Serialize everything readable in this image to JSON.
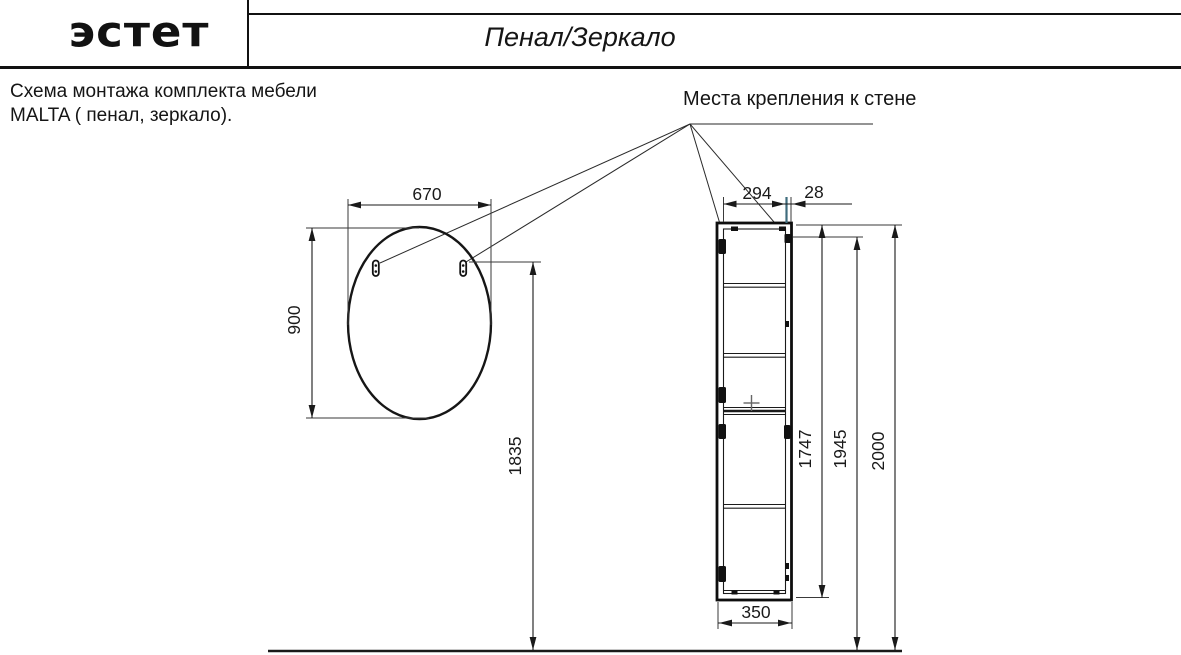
{
  "header": {
    "brand": "эстет",
    "title": "Пенал/Зеркало"
  },
  "intro": {
    "line1": "Схема монтажа комплекта мебели",
    "line2": "MALTA  ( пенал, зеркало)."
  },
  "annotation": {
    "mounting_label": "Места крепления к стене"
  },
  "dimensions": {
    "mirror_width": "670",
    "mirror_height": "900",
    "mirror_mount_height": "1835",
    "cabinet_mount_span": "294",
    "cabinet_mount_edge_offset": "28",
    "cabinet_width": "350",
    "cabinet_height": "1747",
    "cabinet_mount_height": "1945",
    "cabinet_total_height": "2000"
  },
  "colors": {
    "line": "#1a1a1a",
    "accent_teal": "#3f6c7d"
  }
}
